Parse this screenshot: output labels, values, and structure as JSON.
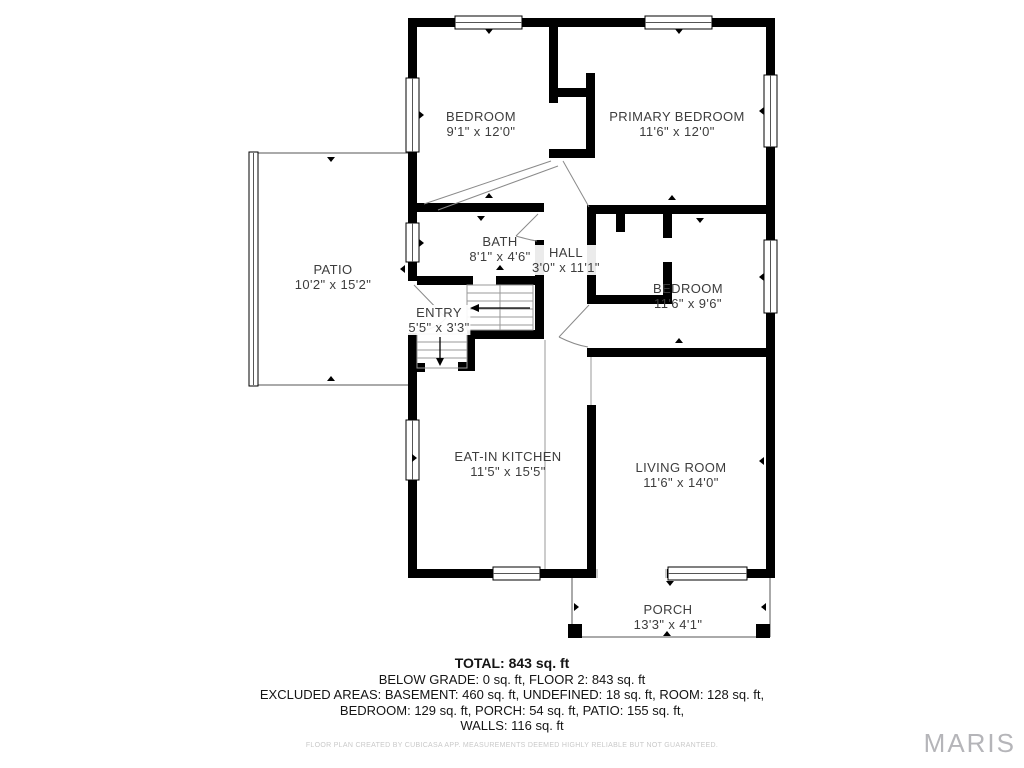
{
  "rooms": {
    "bedroom1": {
      "name": "BEDROOM",
      "dims": "9'1\" x 12'0\""
    },
    "primary": {
      "name": "PRIMARY BEDROOM",
      "dims": "11'6\" x 12'0\""
    },
    "bath": {
      "name": "BATH",
      "dims": "8'1\" x 4'6\""
    },
    "hall": {
      "name": "HALL",
      "dims": "3'0\" x 11'1\""
    },
    "bedroom2": {
      "name": "BEDROOM",
      "dims": "11'6\" x 9'6\""
    },
    "entry": {
      "name": "ENTRY",
      "dims": "5'5\" x 3'3\""
    },
    "patio": {
      "name": "PATIO",
      "dims": "10'2\" x 15'2\""
    },
    "kitchen": {
      "name": "EAT-IN KITCHEN",
      "dims": "11'5\" x 15'5\""
    },
    "living": {
      "name": "LIVING ROOM",
      "dims": "11'6\" x 14'0\""
    },
    "porch": {
      "name": "PORCH",
      "dims": "13'3\" x 4'1\""
    }
  },
  "summary": {
    "total": "TOTAL: 843 sq. ft",
    "line2": "BELOW GRADE: 0 sq. ft, FLOOR 2: 843 sq. ft",
    "line3": "EXCLUDED AREAS: BASEMENT: 460 sq. ft, UNDEFINED: 18 sq. ft, ROOM: 128 sq. ft,",
    "line4": "BEDROOM: 129 sq. ft, PORCH: 54 sq. ft, PATIO: 155 sq. ft,",
    "line5": "WALLS: 116 sq. ft"
  },
  "disclaimer": "FLOOR PLAN CREATED BY CUBICASA APP. MEASUREMENTS DEEMED HIGHLY RELIABLE BUT NOT GUARANTEED.",
  "watermark": "MARIS",
  "colors": {
    "wall": "#000000",
    "room_text": "#3d3d3d",
    "watermark": "#b5b5b9",
    "disclaimer": "#c9c9c9"
  }
}
